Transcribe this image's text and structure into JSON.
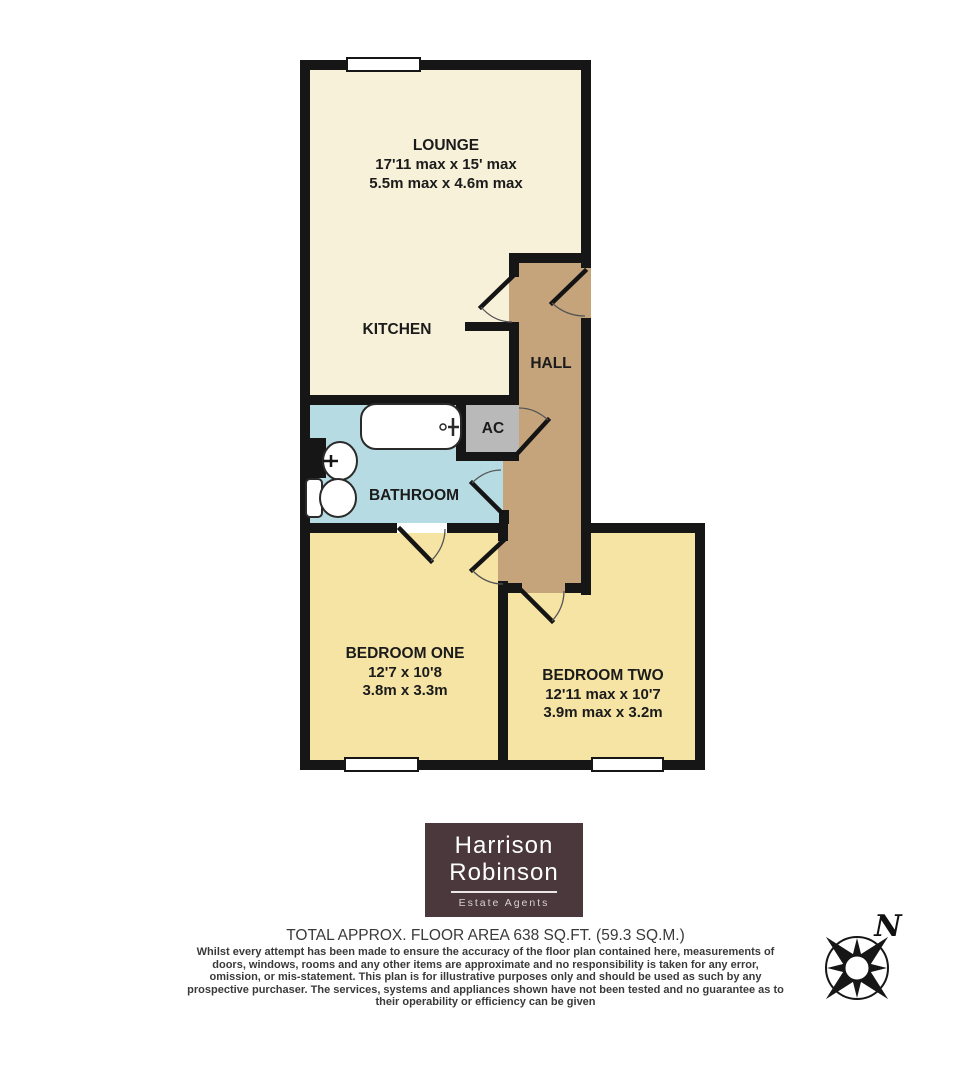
{
  "rooms": {
    "lounge": {
      "name": "LOUNGE",
      "dims_imperial": "17'11 max x 15' max",
      "dims_metric": "5.5m max x 4.6m max"
    },
    "kitchen": {
      "name": "KITCHEN"
    },
    "hall": {
      "name": "HALL"
    },
    "ac": {
      "name": "AC"
    },
    "bathroom": {
      "name": "BATHROOM"
    },
    "bedroom_one": {
      "name": "BEDROOM ONE",
      "dims_imperial": "12'7 x 10'8",
      "dims_metric": "3.8m x 3.3m"
    },
    "bedroom_two": {
      "name": "BEDROOM TWO",
      "dims_imperial": "12'11 max x 10'7",
      "dims_metric": "3.9m max x 3.2m"
    }
  },
  "logo": {
    "name_line1": "Harrison",
    "name_line2": "Robinson",
    "tagline": "Estate Agents"
  },
  "footer": {
    "area_title": "TOTAL APPROX. FLOOR AREA 638 SQ.FT. (59.3 SQ.M.)",
    "disclaimer": "Whilst every attempt has been made to ensure the accuracy of the floor plan contained here, measurements of doors, windows, rooms and any other items are approximate and no responsibility is taken for any error, omission, or mis-statement. This plan is for illustrative purposes only and should be used as such by any prospective purchaser. The services, systems and appliances shown have not been tested and no guarantee as to their operability or efficiency can be given"
  },
  "compass": {
    "north_label": "N"
  },
  "colors": {
    "lounge": "#f7f1d9",
    "bedroom": "#f6e4a4",
    "hall": "#c5a47c",
    "bathroom": "#b6dbe2",
    "ac": "#b9b9b9",
    "wall": "#161616",
    "logo_bg": "#4a383c"
  }
}
